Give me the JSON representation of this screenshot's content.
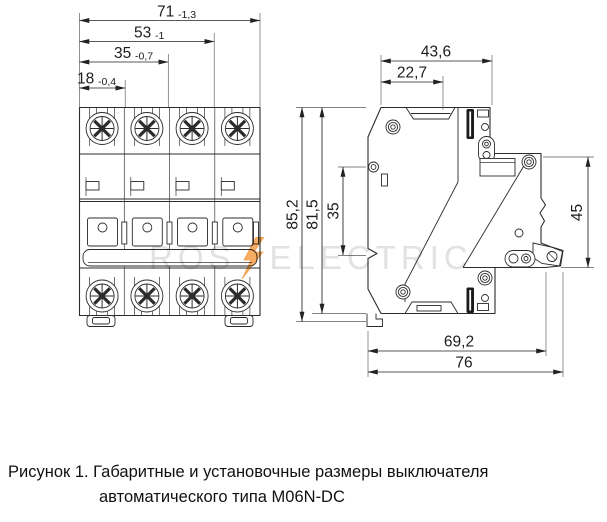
{
  "watermark": {
    "left": "ROS",
    "right": "ELECTRIC",
    "accent_color": "#f5a049"
  },
  "caption": {
    "line1": "Рисунок 1. Габаритные и установочные размеры выключателя",
    "line2": "автоматического типа M06N-DC"
  },
  "dimensions": {
    "front": {
      "total_width": {
        "value": "71",
        "tol": "-1,3"
      },
      "three_pole": {
        "value": "53",
        "tol": "-1"
      },
      "two_pole": {
        "value": "35",
        "tol": "-0,7"
      },
      "one_pole": {
        "value": "18",
        "tol": "-0,4"
      }
    },
    "side": {
      "top_depth": "43,6",
      "front_depth": "22,7",
      "total_height": "85,2",
      "body_height": "81,5",
      "din_window": "35",
      "right_height": "45",
      "bottom_depth": "69,2",
      "max_depth": "76"
    }
  }
}
